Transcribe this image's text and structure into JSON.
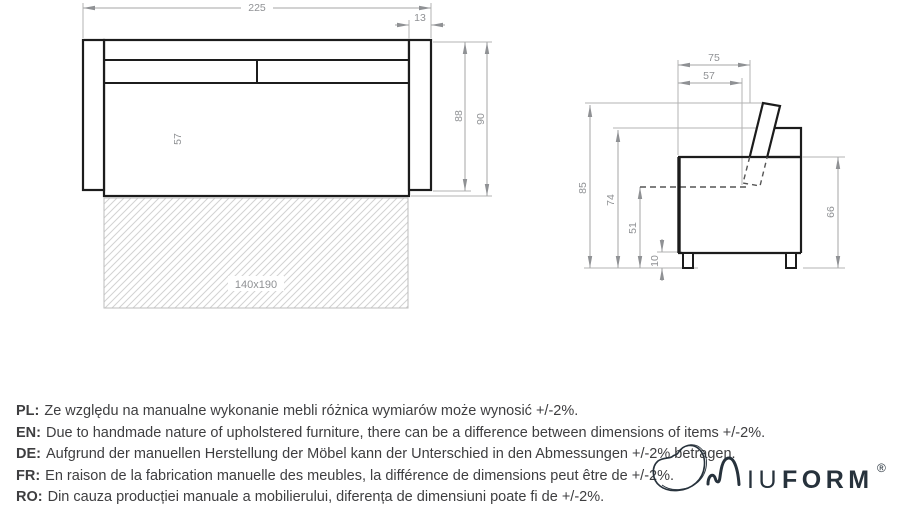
{
  "front_view": {
    "dims": {
      "total_width": "225",
      "armrest_width": "13",
      "body_height": "88",
      "total_height": "90",
      "front_height": "57"
    },
    "mattress_size": "140x190"
  },
  "side_view": {
    "dims": {
      "depth_total": "75",
      "depth_seat": "57",
      "height_total": "85",
      "height_back": "74",
      "height_seat": "51",
      "height_legs": "10",
      "height_arm": "66"
    }
  },
  "disclaimer": {
    "items": [
      {
        "label": "PL:",
        "text": "Ze względu na manualne wykonanie mebli różnica wymiarów może wynosić +/-2%."
      },
      {
        "label": "EN:",
        "text": "Due to handmade nature of upholstered furniture, there can be a difference between dimensions of items +/-2%."
      },
      {
        "label": "DE:",
        "text": "Aufgrund der manuellen Herstellung der Möbel kann der Unterschied in den Abmessungen +/-2% betragen."
      },
      {
        "label": "FR:",
        "text": "En raison de la fabrication manuelle des meubles, la différence de dimensions peut être de +/-2%."
      },
      {
        "label": "RO:",
        "text": "Din cauza producției manuale a mobilierului, diferența de dimensiuni poate fi de +/-2%."
      }
    ]
  },
  "logo": {
    "part1": "IU",
    "part2": "FORM",
    "registered": "®"
  },
  "colors": {
    "furniture_line": "#1c1c1c",
    "dimension_line": "#a6a6a6",
    "dimension_text": "#8f9194",
    "body_text": "#3e3e40",
    "logo": "#27323c"
  }
}
